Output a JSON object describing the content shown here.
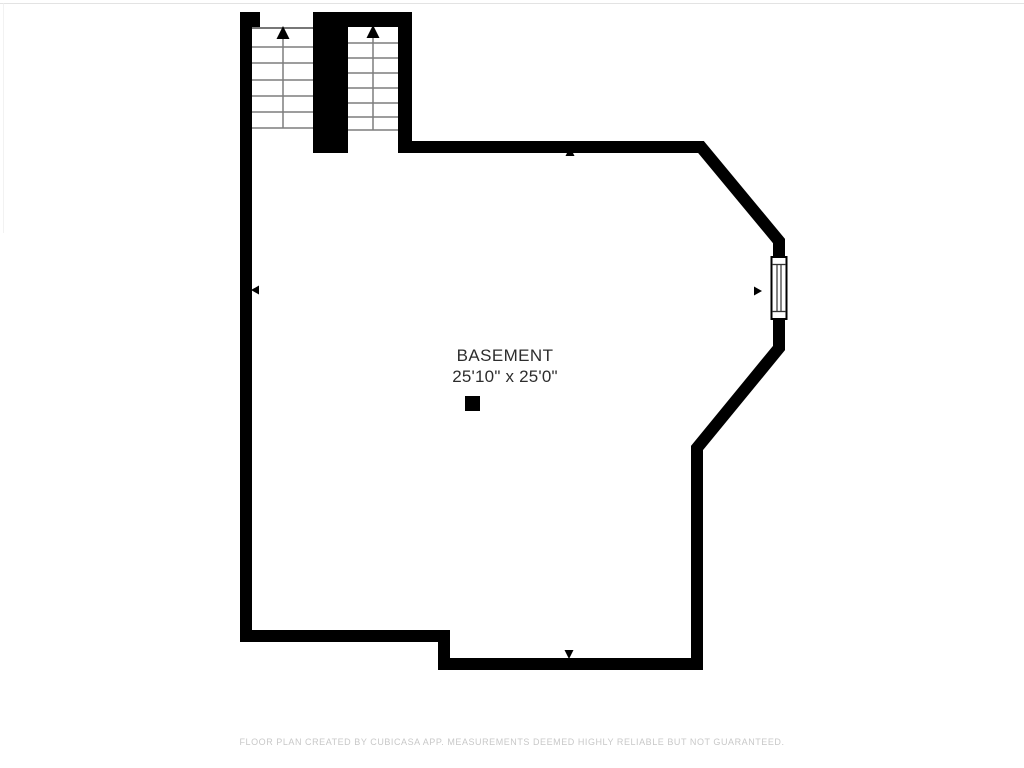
{
  "floor_plan": {
    "room": {
      "name": "BASEMENT",
      "dimensions": "25'10\" x 25'0\""
    },
    "footer": "FLOOR PLAN CREATED BY CUBICASA APP. MEASUREMENTS DEEMED HIGHLY RELIABLE BUT NOT GUARANTEED.",
    "icons": [
      "stairs-up-arrow-icon",
      "measure-marker-north-icon",
      "measure-marker-west-icon",
      "measure-marker-south-icon",
      "measure-marker-east-icon",
      "window-symbol",
      "column-post"
    ],
    "colors": {
      "wall": "#000000",
      "stair_tread": "#7d7d7d",
      "label_text": "#2d2d2d",
      "footer_text": "#c8c8c8",
      "background": "#ffffff"
    }
  }
}
